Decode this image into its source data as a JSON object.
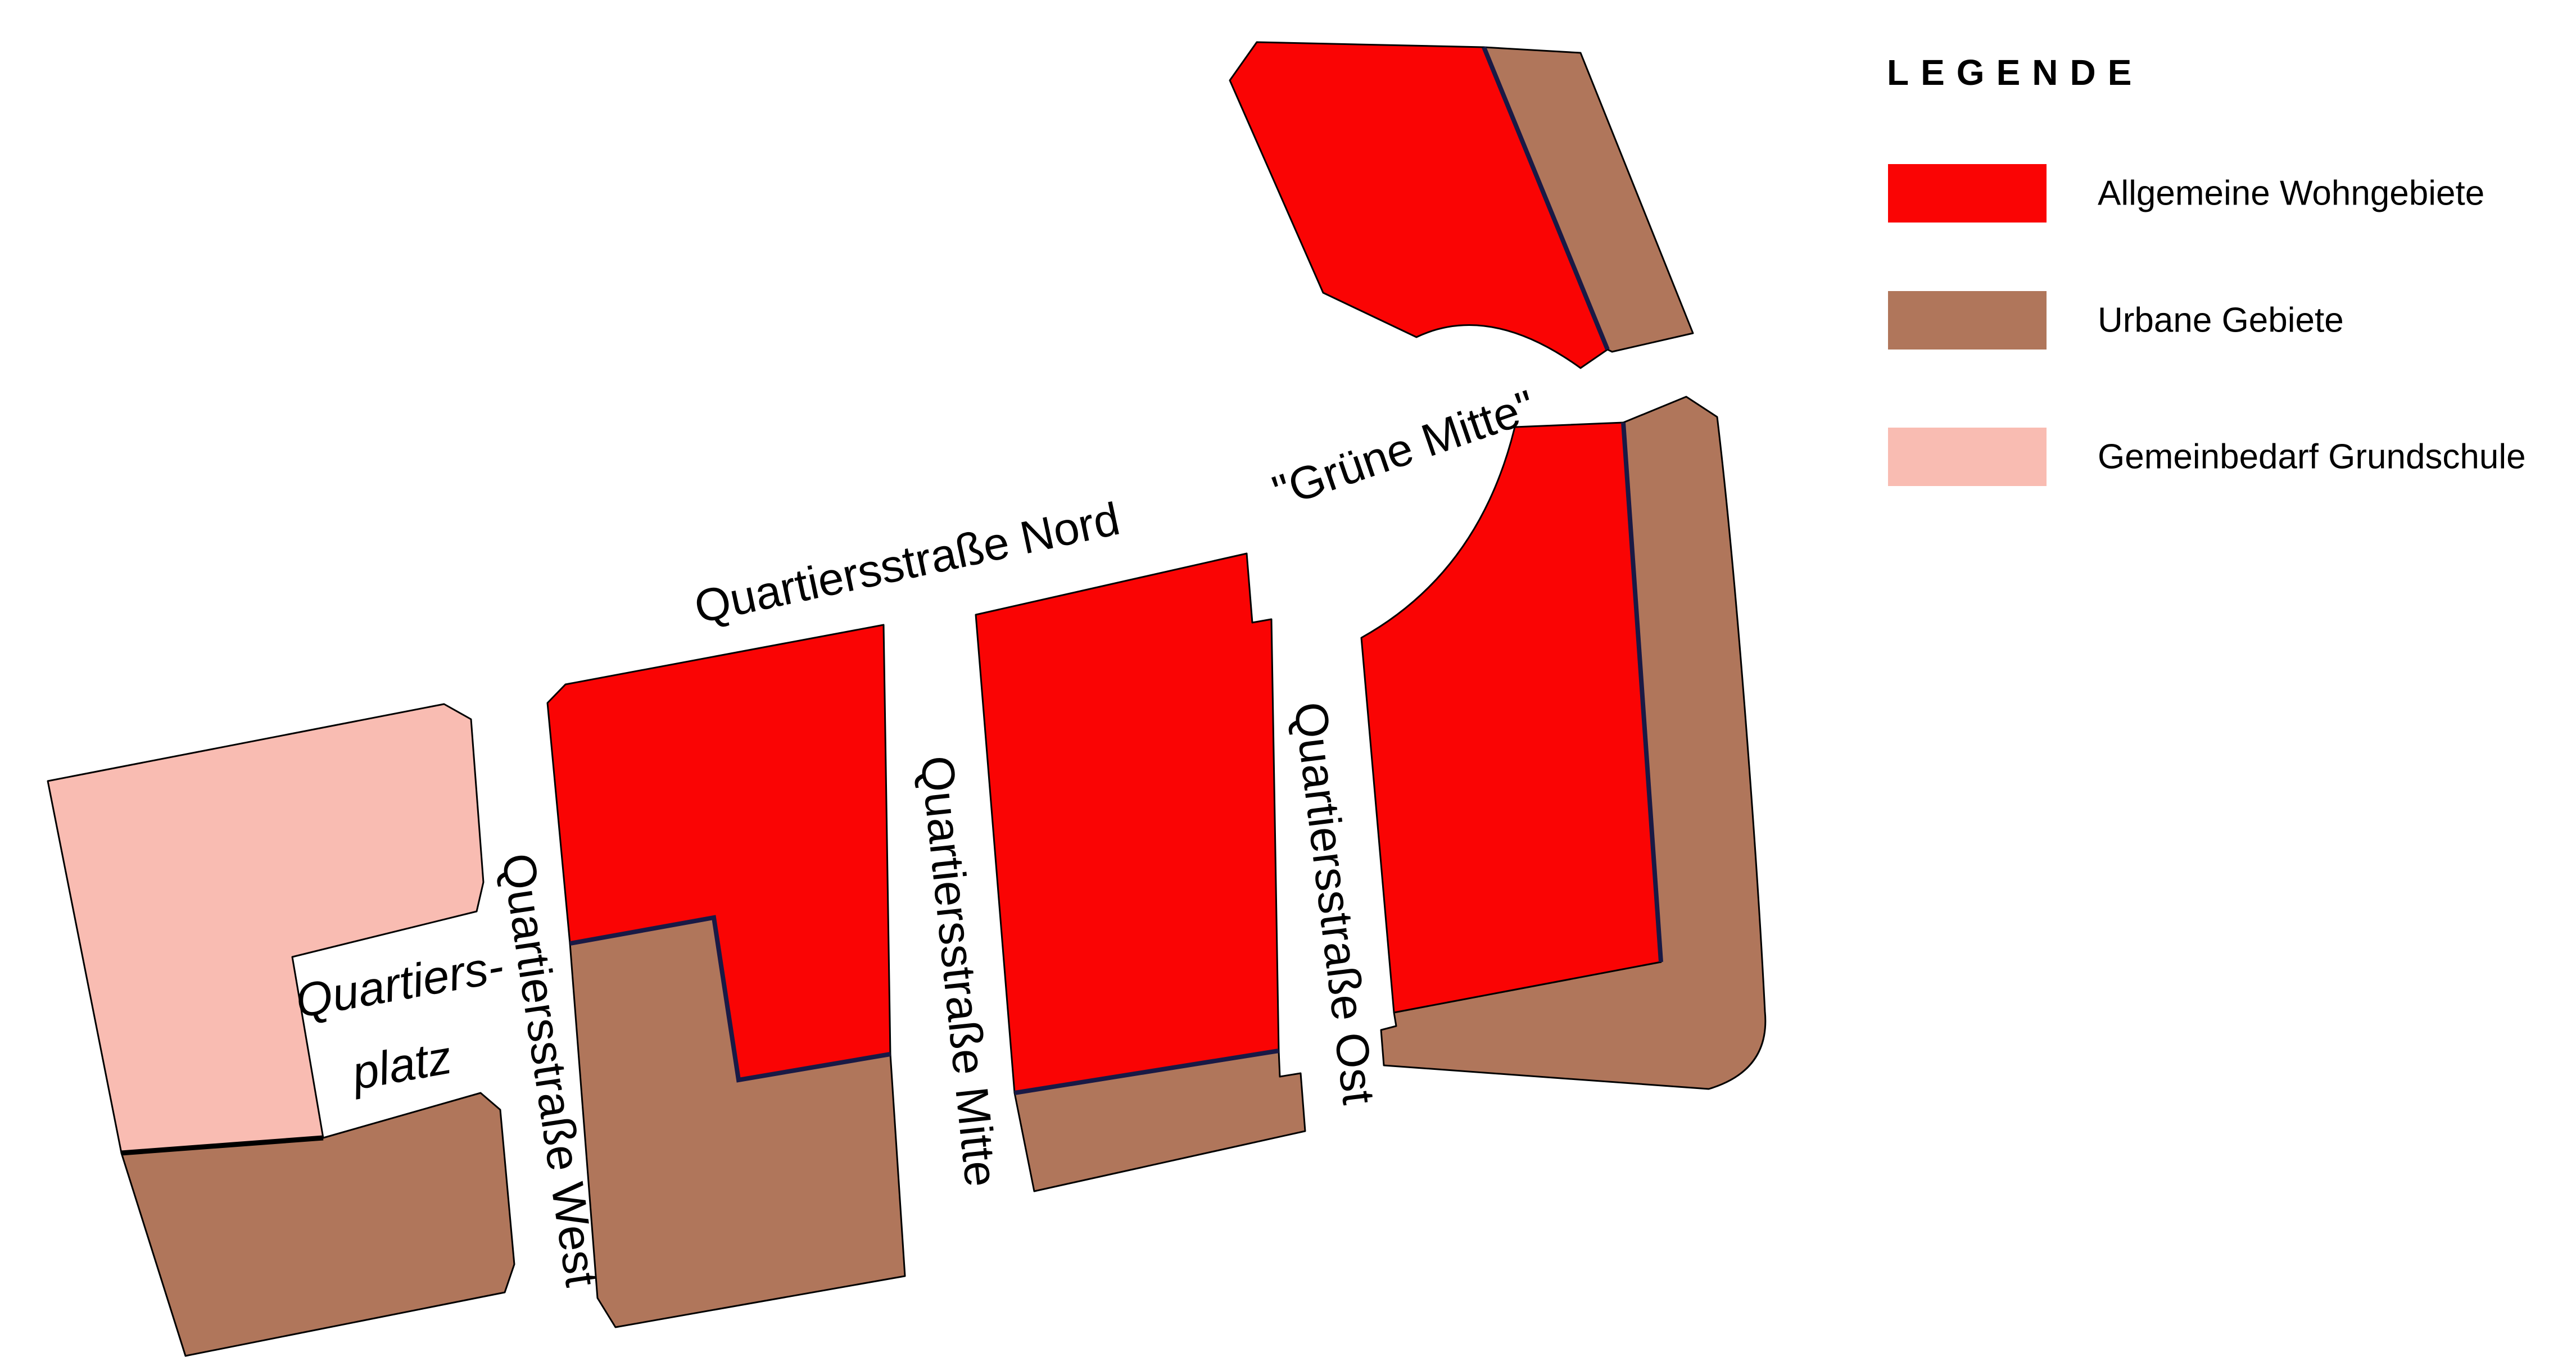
{
  "map": {
    "labels": {
      "nord": {
        "text": "Quartiersstraße Nord"
      },
      "west": {
        "text": "Quartiersstraße West"
      },
      "mitte": {
        "text": "Quartiersstraße Mitte"
      },
      "ost": {
        "text": "Quartiersstraße Ost"
      },
      "gruene_mitte": {
        "text": "\"Grüne Mitte\""
      },
      "quartiersplatz_line1": {
        "text": "Quartiers-"
      },
      "quartiersplatz_line2": {
        "text": "platz"
      }
    }
  },
  "legend": {
    "title": "LEGENDE",
    "items": [
      {
        "label": "Allgemeine Wohngebiete",
        "color": "#fa0404"
      },
      {
        "label": "Urbane Gebiete",
        "color": "#b0765b"
      },
      {
        "label": "Gemeinbedarf Grundschule",
        "color": "#f9bcb2"
      }
    ]
  },
  "colors": {
    "residential": "#fa0404",
    "urban": "#b0765b",
    "school": "#f9bcb2",
    "divider": "#191945",
    "outline": "#000000",
    "background": "#ffffff"
  }
}
